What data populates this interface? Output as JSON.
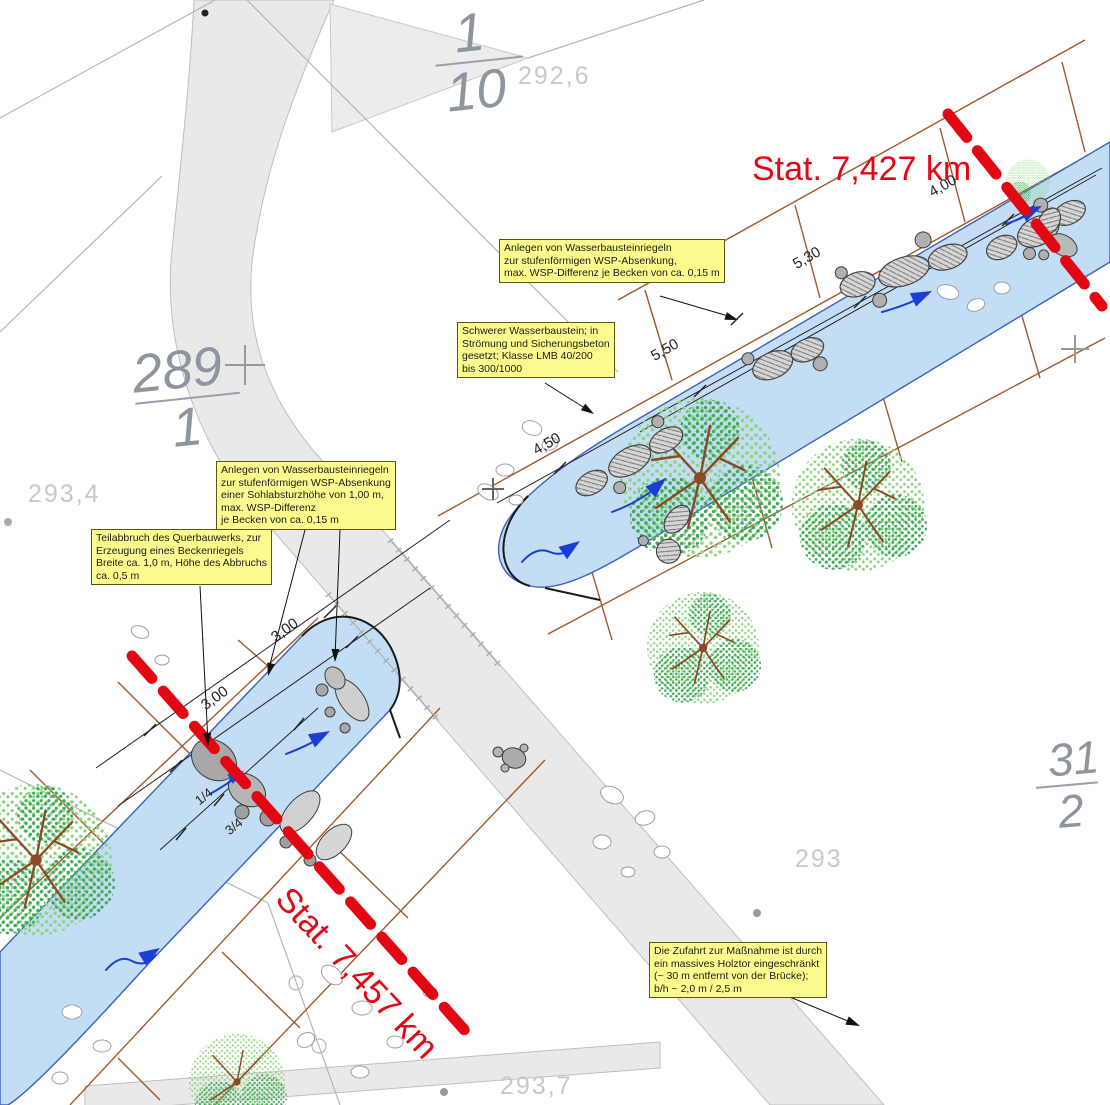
{
  "colors": {
    "water": "#c2ddf4",
    "road": "#e9e9e9",
    "red": "#e30613",
    "yellow": "#fcfc8e",
    "brown": "#a0582b",
    "grayline": "#b6b6b6",
    "parcel": "#8e959e",
    "elev": "#c9c9c9",
    "tree_light": "#8ed47f",
    "tree_dark": "#3fa85c",
    "trunk": "#8a4a26",
    "boulder": "#d6d6d6",
    "blue": "#1b3fd4",
    "black": "#1a1a1a"
  },
  "station_lines": [
    {
      "label": "Stat. 7,427 km"
    },
    {
      "label": "Stat. 7,457 km"
    }
  ],
  "annotation_boxes": [
    {
      "id": "riegel-upper",
      "lines": [
        "Anlegen von Wasserbausteinriegeln",
        "zur stufenförmigen WSP-Absenkung,",
        "max. WSP-Differenz je Becken von ca. 0,15 m"
      ]
    },
    {
      "id": "wasserbaustein",
      "lines": [
        "Schwerer Wasserbaustein; in",
        "Strömung und Sicherungsbeton",
        "gesetzt; Klasse LMB 40/200",
        "bis 300/1000"
      ]
    },
    {
      "id": "riegel-lower",
      "lines": [
        "Anlegen von Wasserbausteinriegeln",
        "zur stufenförmigen WSP-Absenkung",
        "einer Sohlabsturzhöhe von 1,00 m,",
        "max. WSP-Differenz",
        "je Becken von ca. 0,15 m"
      ]
    },
    {
      "id": "teilabbruch",
      "lines": [
        "Teilabbruch des Querbauwerks, zur",
        "Erzeugung eines Beckenriegels",
        "Breite ca. 1,0 m, Höhe des Abbruchs",
        "ca. 0,5 m"
      ]
    },
    {
      "id": "zufahrt",
      "lines": [
        "Die Zufahrt zur Maßnahme ist durch",
        "ein massives Holztor eingeschränkt",
        "(~ 30 m entfernt von der Brücke);",
        "b/h ~ 2,0 m / 2,5 m"
      ]
    }
  ],
  "parcel_labels": [
    {
      "numerator": "1",
      "denominator": "10"
    },
    {
      "numerator": "289",
      "denominator": "1"
    },
    {
      "numerator": "31",
      "denominator": "2"
    }
  ],
  "elevation_labels": [
    {
      "value": "292,6"
    },
    {
      "value": "293,4"
    },
    {
      "value": "293"
    },
    {
      "value": "293,7"
    }
  ],
  "dimension_labels": [
    {
      "value": "4,00"
    },
    {
      "value": "5,30"
    },
    {
      "value": "5,50"
    },
    {
      "value": "4,50"
    },
    {
      "value": "3,00"
    },
    {
      "value": "3,00"
    },
    {
      "value": "1/4"
    },
    {
      "value": "3/4"
    }
  ],
  "symbols": {
    "flow_arrow": "blue directional flow arrow",
    "station_line": "red dashed chainage line",
    "tree": "stippled canopy with brown branches",
    "boulder_riegel": "hatched stone group",
    "grid_cross": "+"
  }
}
